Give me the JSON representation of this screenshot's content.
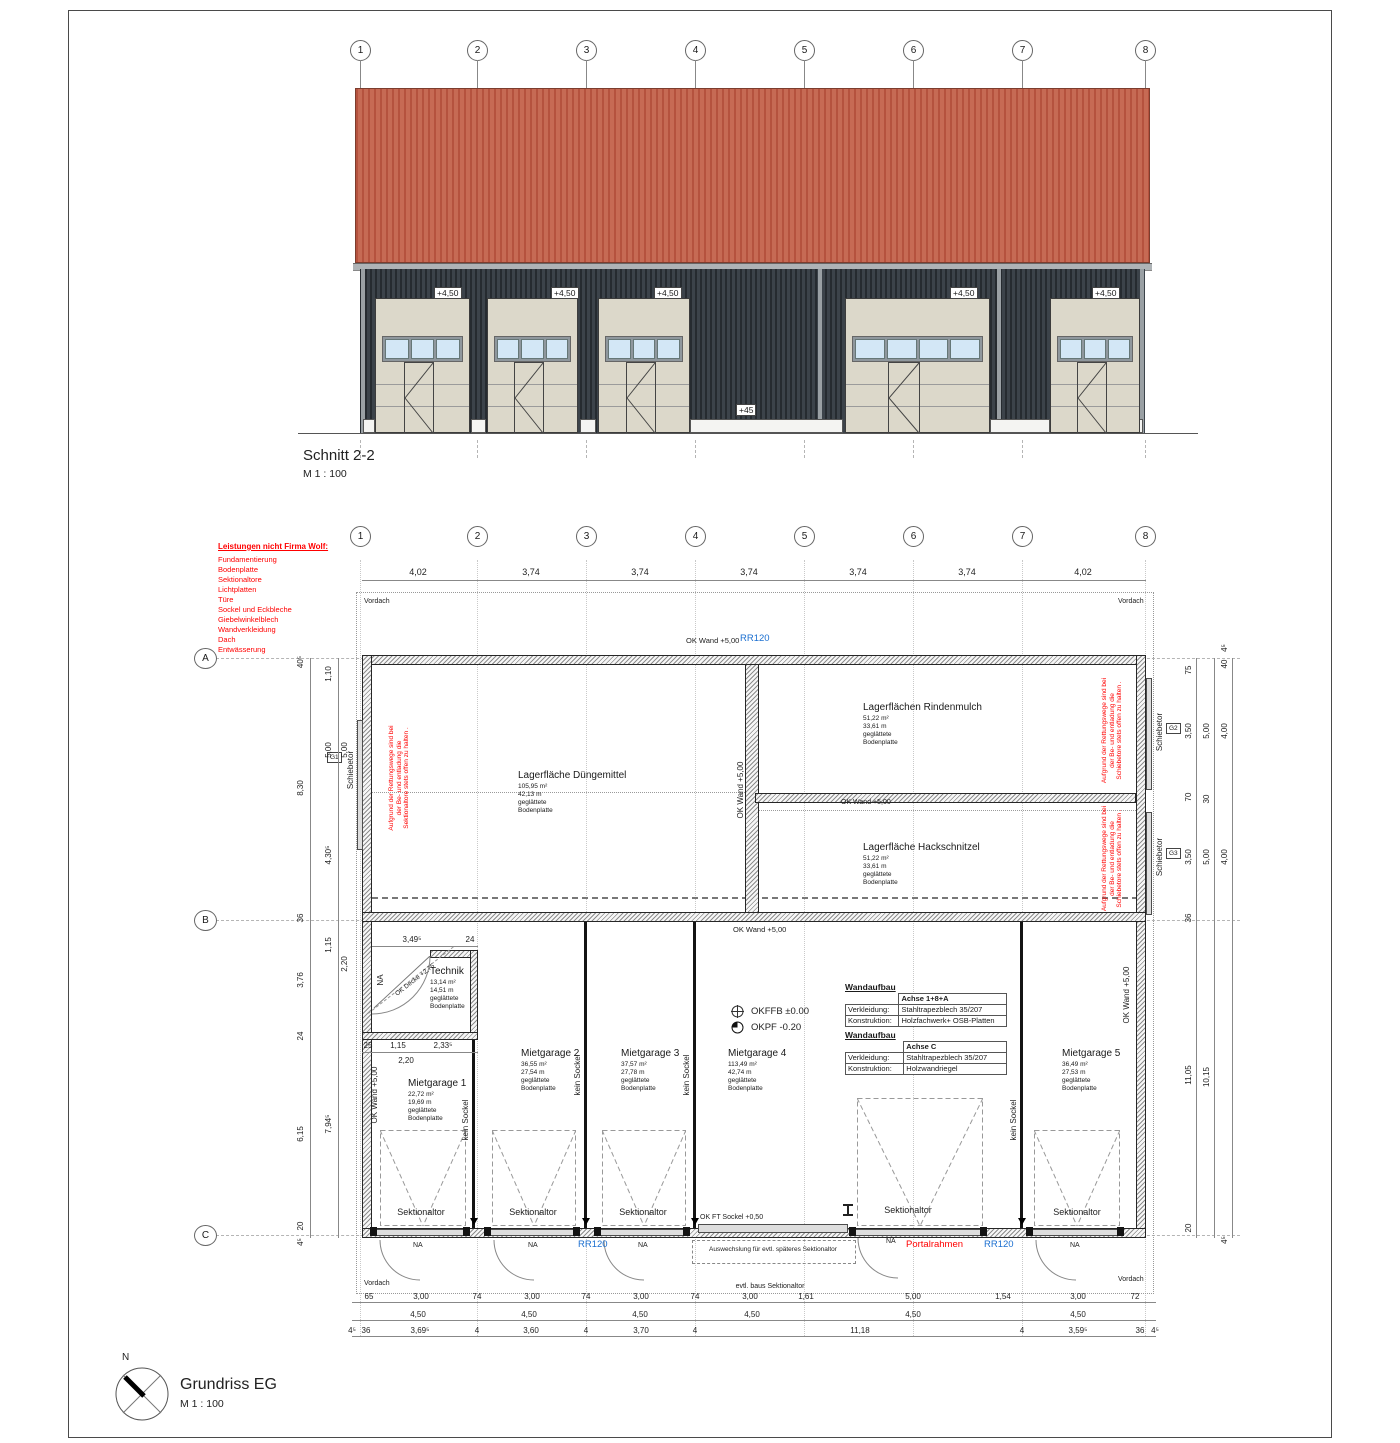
{
  "grid": [
    "1",
    "2",
    "3",
    "4",
    "5",
    "6",
    "7",
    "8"
  ],
  "rowsABC": [
    "A",
    "B",
    "C"
  ],
  "section": {
    "title": "Schnitt 2-2",
    "scale": "M 1 : 100",
    "level": "+4,50",
    "plinth": "+45"
  },
  "plan": {
    "title": "Grundriss EG",
    "scale": "M 1 : 100",
    "north": "N"
  },
  "note": {
    "title": "Leistungen nicht Firma Wolf:",
    "items": [
      "Fundamentierung",
      "Bodenplatte",
      "Sektionaltore",
      "Lichtplatten",
      "Türe",
      "Sockel und Eckbleche",
      "Giebelwinkelblech",
      "Wandverkleidung",
      "Dach",
      "Entwässerung"
    ]
  },
  "labels": {
    "ok_wand": "OK Wand +5,00",
    "rr120": "RR120",
    "vordach": "Vordach",
    "schiebetor": "Schiebetor",
    "kein_sockel": "kein Sockel",
    "sektionaltor": "Sektionaltor",
    "na": "NA",
    "ok_decke": "OK Decke +2,75",
    "okffb": "OKFFB ±0.00",
    "okpf": "OKPF  -0.20",
    "portal": "Portalrahmen",
    "ok_ft": "OK FT Sockel +0,50",
    "auswechslung": "Auswechslung für evtl. späteres Sektionaltor",
    "evtl": "evtl. baus Sektionaltor",
    "g1": "G1",
    "g2": "G2",
    "g3": "G3"
  },
  "rescue_sek": [
    "Aufgrund der Rettungswege sind bei",
    "der Be- und entladung die",
    "Sektionaltore stets offen zu halten ."
  ],
  "rescue_schiebe": [
    "Aufgrund der Rettungswege sind bei",
    "der Be- und entladung die",
    "Schiebetore stets offen zu halten ."
  ],
  "rooms": {
    "dunger": {
      "name": "Lagerfläche Düngemittel",
      "l1": "105,95 m²",
      "l2": "42,13 m",
      "l3": "geglättete",
      "l4": "Bodenplatte"
    },
    "rinden": {
      "name": "Lagerflächen Rindenmulch",
      "l1": "51,22 m²",
      "l2": "33,61 m",
      "l3": "geglättete",
      "l4": "Bodenplatte"
    },
    "hack": {
      "name": "Lagerfläche Hackschnitzel",
      "l1": "51,22 m²",
      "l2": "33,61 m",
      "l3": "geglättete",
      "l4": "Bodenplatte"
    },
    "technik": {
      "name": "Technik",
      "l1": "13,14 m²",
      "l2": "14,51 m",
      "l3": "geglättete",
      "l4": "Bodenplatte"
    },
    "mg1": {
      "name": "Mietgarage 1",
      "l1": "22,72 m²",
      "l2": "19,69 m",
      "l3": "geglättete",
      "l4": "Bodenplatte"
    },
    "mg2": {
      "name": "Mietgarage 2",
      "l1": "36,55 m²",
      "l2": "27,54 m",
      "l3": "geglättete",
      "l4": "Bodenplatte"
    },
    "mg3": {
      "name": "Mietgarage 3",
      "l1": "37,57 m²",
      "l2": "27,78 m",
      "l3": "geglättete",
      "l4": "Bodenplatte"
    },
    "mg4": {
      "name": "Mietgarage 4",
      "l1": "113,49 m²",
      "l2": "42,74 m",
      "l3": "geglättete",
      "l4": "Bodenplatte"
    },
    "mg5": {
      "name": "Mietgarage 5",
      "l1": "36,49 m²",
      "l2": "27,53 m",
      "l3": "geglättete",
      "l4": "Bodenplatte"
    }
  },
  "wand1": {
    "t": "Wandaufbau",
    "achse": "Achse 1+8+A",
    "k1": "Verkleidung:",
    "v1": "Stahltrapezblech  35/207",
    "k2": "Konstruktion:",
    "v2": "Holzfachwerk+ OSB-Platten"
  },
  "wand2": {
    "t": "Wandaufbau",
    "achse": "Achse C",
    "k1": "Verkleidung:",
    "v1": "Stahltrapezblech  35/207",
    "k2": "Konstruktion:",
    "v2": "Holzwandriegel"
  },
  "dims": {
    "top": [
      "4,02",
      "3,74",
      "3,74",
      "3,74",
      "3,74",
      "3,74",
      "4,02"
    ],
    "b1": [
      "65",
      "3,00",
      "74",
      "3,00",
      "74",
      "3,00",
      "74",
      "3,00",
      "1,61",
      "5,00",
      "1,54",
      "3,00",
      "72"
    ],
    "b2": [
      "4,50",
      "4,50",
      "4,50",
      "4,50",
      "4,50",
      "4,50"
    ],
    "b3": [
      "4⁵",
      "36",
      "3,69⁵",
      "4",
      "3,60",
      "4",
      "3,70",
      "4",
      "11,18",
      "4",
      "3,59⁵",
      "36",
      "4⁵"
    ],
    "lo": [
      "40⁵",
      "8,30",
      "36",
      "3,76",
      "24",
      "6,15",
      "20",
      "4⁵"
    ],
    "li": [
      "1,10",
      "5,00",
      "5,00",
      "4,30⁵",
      "1,15",
      "2,20",
      "7,94⁵"
    ],
    "ri": [
      "75",
      "3,50",
      "70",
      "3,50",
      "36",
      "11,05",
      "20"
    ],
    "rm": [
      "5,00",
      "30",
      "5,00",
      "10,15"
    ],
    "ro": [
      "4⁵",
      "40",
      "4,00",
      "4,00",
      "4⁵"
    ],
    "tt": [
      "3,49⁵",
      "24"
    ],
    "tb": [
      "25",
      "1,15",
      "2,33⁵",
      "2,20"
    ]
  },
  "colors": {
    "roof": "#c2604a",
    "facade": "#343a41",
    "door": "#dcd8ca",
    "window": "#d3e7f6",
    "note_red": "#ff0000",
    "annot_blue": "#1b6fd0"
  }
}
